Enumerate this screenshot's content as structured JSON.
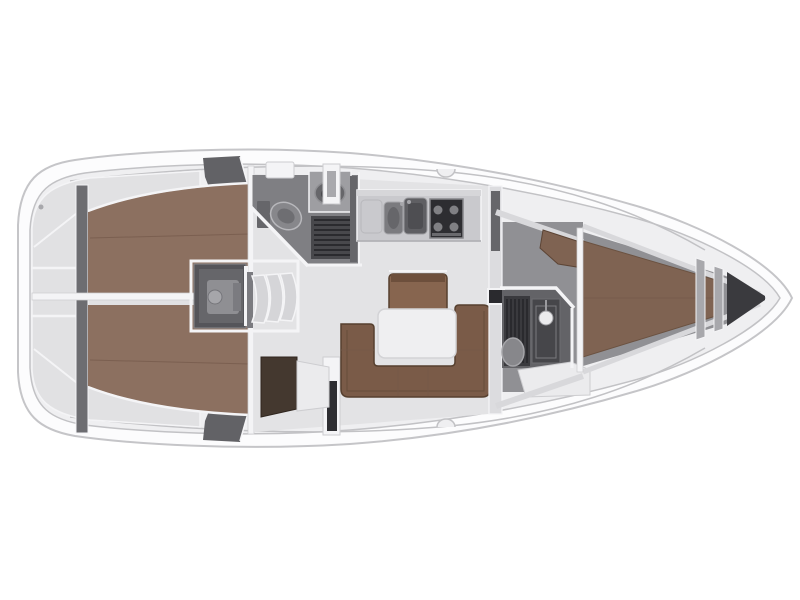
{
  "meta": {
    "type": "yacht-interior-floor-plan",
    "view": "top-down",
    "orientation": "bow-right",
    "canvas": {
      "width": 800,
      "height": 600
    }
  },
  "colors": {
    "hull_fill": "#fcfcfd",
    "hull_stroke": "#c5c5c8",
    "deck_fill": "#efeff1",
    "deck_stroke": "#c2c2c5",
    "white_trim": "#f4f4f6",
    "divider_stroke": "#cdcdd0",
    "locker_fill": "#e1e1e3",
    "locker_wall_dark": "#6d6d71",
    "bulkhead_dark": "#626266",
    "floor_salon": "#e3e3e5",
    "floor_fwd": "#909094",
    "shelf_light": "#d8d8db",
    "berth_aft": "#8c7060",
    "berth_seam": "#73594a",
    "berth_fwd": "#7f6352",
    "settee": "#7a5b48",
    "settee_edge": "#56402f",
    "bench": "#87654f",
    "bench_rail": "#6d4f3c",
    "table_fill": "#efeff1",
    "table_stroke": "#d3d3d6",
    "cabinet_dark": "#44382f",
    "seat_white": "#ebebed",
    "engine_box": "#55555a",
    "engine_inner": "#66666a",
    "engine_part": "#8f8f93",
    "engine_part2": "#a6a6aa",
    "engine_part3": "#7b7b80",
    "step_fill": "#d5d5d8",
    "head_floor": "#7f7f83",
    "head_floor_fwd": "#636367",
    "grate_aft": "#48484c",
    "grate_fwd": "#3a3a3e",
    "grate_line": "#2a2a2e",
    "toilet_body": "#87878b",
    "toilet_inner": "#6e6e72",
    "sink_cabinet": "#9e9ea2",
    "basin": "#66666a",
    "counter": "#c9c9cd",
    "counter_top": "#d6d6d9",
    "counter_lip": "#a7a7ab",
    "sink_small": "#7b7b7f",
    "sink_large": "#5f5f63",
    "stove": "#2d2d31",
    "burner": "#808084",
    "shower_col": "#46464a",
    "showerhead": "#ebebed",
    "mast": "#2a2a2e",
    "wall_light": "#dcdcdf",
    "wall_dark_seg": "#66666a",
    "anchor_dark": "#3a3a3e",
    "bar_gray": "#a8a8ac",
    "fitting_dark": "#2e2e32",
    "fitting_gray": "#a9a9ad"
  },
  "elements": [
    {
      "name": "hull",
      "kind": "boat-hull-outline"
    },
    {
      "name": "stern-lockers",
      "kind": "cockpit-stowage"
    },
    {
      "name": "aft-cabin-port-berth",
      "kind": "double-berth"
    },
    {
      "name": "aft-cabin-starboard-berth",
      "kind": "double-berth"
    },
    {
      "name": "engine-compartment",
      "kind": "machinery"
    },
    {
      "name": "companionway-steps",
      "kind": "stairs"
    },
    {
      "name": "aft-head",
      "kind": "bathroom",
      "fixtures": [
        "toilet",
        "washbasin",
        "shower-grate"
      ]
    },
    {
      "name": "galley",
      "kind": "kitchen",
      "fixtures": [
        "double-sink",
        "stove",
        "counter"
      ]
    },
    {
      "name": "salon",
      "kind": "living-area",
      "fixtures": [
        "u-settee",
        "table",
        "bench-seat"
      ]
    },
    {
      "name": "nav-cabinet",
      "kind": "furniture"
    },
    {
      "name": "mast-post",
      "kind": "structure"
    },
    {
      "name": "forward-head",
      "kind": "bathroom",
      "fixtures": [
        "toilet",
        "shower-column",
        "shower-grate",
        "bench"
      ]
    },
    {
      "name": "forward-cabin",
      "kind": "sleeping-area",
      "fixtures": [
        "v-berth",
        "seat"
      ]
    },
    {
      "name": "anchor-locker",
      "kind": "bow-stowage"
    }
  ]
}
